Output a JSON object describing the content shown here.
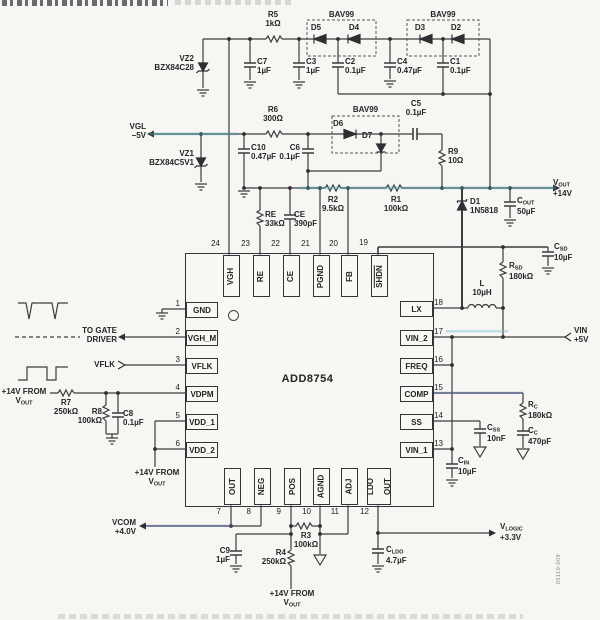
{
  "doc_code": "05110-009",
  "chip": {
    "name": "ADD8754",
    "pins_top": [
      {
        "num": "24",
        "label": "VGH"
      },
      {
        "num": "23",
        "label": "RE"
      },
      {
        "num": "22",
        "label": "CE"
      },
      {
        "num": "21",
        "label": "PGND"
      },
      {
        "num": "20",
        "label": "FB"
      },
      {
        "num": "19",
        "label": "SHDN"
      }
    ],
    "pins_bottom": [
      {
        "num": "7",
        "label": "OUT"
      },
      {
        "num": "8",
        "label": "NEG"
      },
      {
        "num": "9",
        "label": "POS"
      },
      {
        "num": "10",
        "label": "AGND"
      },
      {
        "num": "11",
        "label": "ADJ"
      },
      {
        "num": "12",
        "label": "LDO",
        "label2": "OUT"
      }
    ],
    "pins_left": [
      {
        "num": "1",
        "label": "GND"
      },
      {
        "num": "2",
        "label": "VGH_M"
      },
      {
        "num": "3",
        "label": "VFLK"
      },
      {
        "num": "4",
        "label": "VDPM"
      },
      {
        "num": "5",
        "label": "VDD_1"
      },
      {
        "num": "6",
        "label": "VDD_2"
      }
    ],
    "pins_right": [
      {
        "num": "18",
        "label": "LX"
      },
      {
        "num": "17",
        "label": "VIN_2"
      },
      {
        "num": "16",
        "label": "FREQ"
      },
      {
        "num": "15",
        "label": "COMP"
      },
      {
        "num": "14",
        "label": "SS"
      },
      {
        "num": "13",
        "label": "VIN_1"
      }
    ]
  },
  "nets": {
    "vgl": {
      "name": "VGL",
      "value": "−5V"
    },
    "vout": {
      "base": "V",
      "sub": "OUT",
      "value": "+14V"
    },
    "vin": {
      "name": "VIN",
      "value": "+5V"
    },
    "vcom": {
      "name": "VCOM",
      "value": "+4.0V"
    },
    "vlogic": {
      "base": "V",
      "sub": "LOGIC",
      "value": "+3.3V"
    },
    "gate": {
      "line1": "TO GATE",
      "line2": "DRIVER"
    },
    "vflk": {
      "name": "VFLK"
    },
    "supply14": {
      "line1": "+14V FROM",
      "base": "V",
      "sub": "OUT"
    }
  },
  "parts": {
    "r1": {
      "ref": "R1",
      "value": "100kΩ"
    },
    "r2": {
      "ref": "R2",
      "value": "9.5kΩ"
    },
    "r3": {
      "ref": "R3",
      "value": "100kΩ"
    },
    "r4": {
      "ref": "R4",
      "value": "250kΩ"
    },
    "r5": {
      "ref": "R5",
      "value": "1kΩ"
    },
    "r6": {
      "ref": "R6",
      "value": "300Ω"
    },
    "r7": {
      "ref": "R7",
      "value": "250kΩ"
    },
    "r8": {
      "ref": "R8",
      "value": "100kΩ"
    },
    "r9": {
      "ref": "R9",
      "value": "10Ω"
    },
    "re": {
      "ref": "RE",
      "value": "33kΩ"
    },
    "ce": {
      "ref": "CE",
      "value": "390pF"
    },
    "c1": {
      "ref": "C1",
      "value": "0.1µF"
    },
    "c2": {
      "ref": "C2",
      "value": "0.1µF"
    },
    "c3": {
      "ref": "C3",
      "value": "1µF"
    },
    "c4": {
      "ref": "C4",
      "value": "0.47µF"
    },
    "c5": {
      "ref": "C5",
      "value": "0.1µF"
    },
    "c6": {
      "ref": "C6",
      "value": "0.1µF"
    },
    "c7": {
      "ref": "C7",
      "value": "1µF"
    },
    "c8": {
      "ref": "C8",
      "value": "0.1µF"
    },
    "c9": {
      "ref": "C9",
      "value": "1µF"
    },
    "c10": {
      "ref": "C10",
      "value": "0.47µF"
    },
    "vz1": {
      "ref": "VZ1",
      "value": "BZX84C5V1"
    },
    "vz2": {
      "ref": "VZ2",
      "value": "BZX84C28"
    },
    "d1": {
      "ref": "D1",
      "value": "1N5818"
    },
    "d2": {
      "ref": "D2"
    },
    "d3": {
      "ref": "D3"
    },
    "d4": {
      "ref": "D4"
    },
    "d5": {
      "ref": "D5"
    },
    "d6": {
      "ref": "D6"
    },
    "d7": {
      "ref": "D7"
    },
    "bav99": {
      "ref": "BAV99"
    },
    "l": {
      "ref": "L",
      "value": "10µH"
    },
    "cout": {
      "base": "C",
      "sub": "OUT",
      "value": "50µF"
    },
    "csd": {
      "base": "C",
      "sub": "SD",
      "value": "10µF"
    },
    "rsd": {
      "base": "R",
      "sub": "SD",
      "value": "180kΩ"
    },
    "rc": {
      "base": "R",
      "sub": "C",
      "value": "180kΩ"
    },
    "cc": {
      "base": "C",
      "sub": "C",
      "value": "470pF"
    },
    "css": {
      "base": "C",
      "sub": "SS",
      "value": "10nF"
    },
    "cin": {
      "base": "C",
      "sub": "IN",
      "value": "10µF"
    },
    "cldo": {
      "base": "C",
      "sub": "LDO",
      "value": "4.7µF"
    }
  }
}
